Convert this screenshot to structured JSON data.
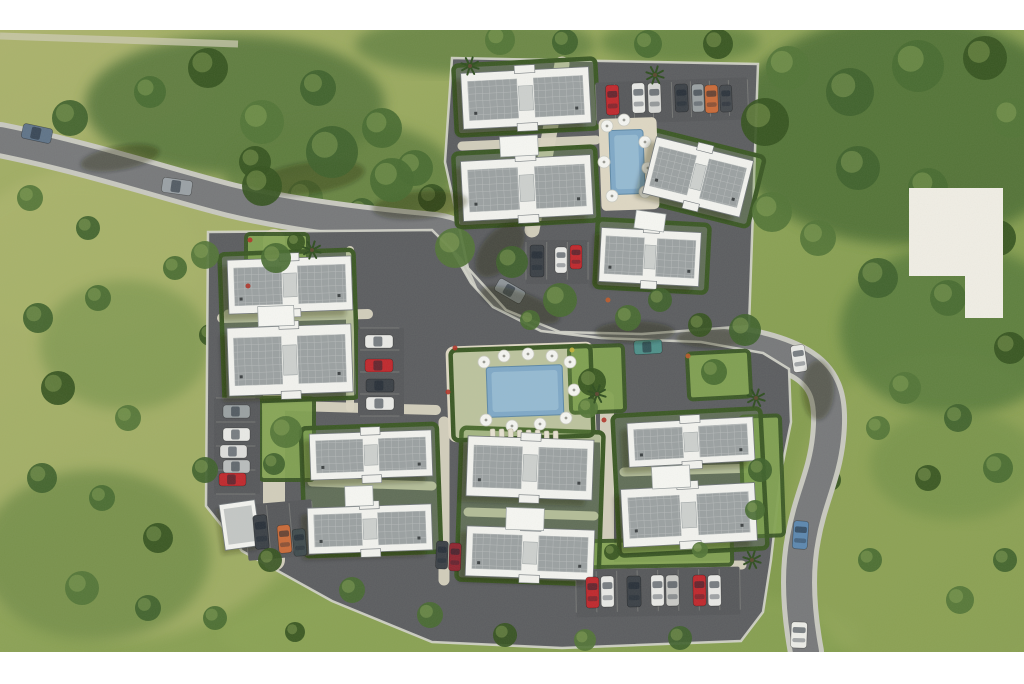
{
  "meta": {
    "scene": "aerial 3D rendering of a residential site plan with apartment blocks, roads, parking and pools"
  },
  "canvas": {
    "width": 1024,
    "height": 684,
    "photo_top": 30,
    "photo_bottom": 652,
    "letterbox_color": "#ffffff"
  },
  "palette": {
    "grass_a": "#a8b169",
    "grass_b": "#7c9748",
    "road": "#77787b",
    "sidewalk": "#c9c9c1",
    "parcel": "#5b5c60",
    "parcel_edge": "#d6d6cd",
    "walkway": "#d9d3c1",
    "hedge": "#3a5724",
    "lawn": "#83a352",
    "building_white": "#f3f3f0",
    "roof_gray": "#9ba0a2",
    "roof_core": "#cdd0cf",
    "pool_deck": "#ded7c4",
    "water": "#7fa8c8",
    "water_light": "#a8c8dd",
    "lot": "#56575b",
    "stall_line": "#8e8e8a",
    "logo_box": "#f1eee6",
    "tree_colors": [
      "#3f612c",
      "#486a31",
      "#35531f",
      "#527437"
    ]
  },
  "scene": {
    "grass_patches": [
      [
        120,
        400,
        230,
        240,
        "#b3b873",
        0.5
      ],
      [
        60,
        80,
        150,
        60,
        "#b0b572",
        0.45
      ],
      [
        540,
        635,
        320,
        55,
        "#8da557",
        0.5
      ],
      [
        940,
        520,
        150,
        170,
        "#96a75c",
        0.55
      ],
      [
        420,
        320,
        120,
        90,
        "#9fae63",
        0.35
      ],
      [
        80,
        260,
        120,
        80,
        "#a9b46b",
        0.4
      ]
    ],
    "forests": [
      [
        235,
        105,
        150,
        70,
        "#55753b",
        0.85
      ],
      [
        340,
        175,
        115,
        55,
        "#5d7c3e",
        0.8
      ],
      [
        905,
        130,
        175,
        115,
        "#4d6e34",
        0.88
      ],
      [
        955,
        330,
        115,
        85,
        "#55783a",
        0.8
      ],
      [
        95,
        555,
        115,
        85,
        "#60803e",
        0.6
      ],
      [
        125,
        345,
        85,
        65,
        "#6a8a44",
        0.5
      ],
      [
        955,
        465,
        85,
        55,
        "#6b8a45",
        0.5
      ],
      [
        475,
        45,
        120,
        30,
        "#5a7a3c",
        0.7
      ],
      [
        680,
        42,
        80,
        22,
        "#587a3a",
        0.7
      ]
    ],
    "trees": [
      [
        70,
        118,
        18
      ],
      [
        150,
        92,
        16
      ],
      [
        208,
        68,
        20
      ],
      [
        262,
        122,
        22
      ],
      [
        318,
        88,
        18
      ],
      [
        382,
        128,
        20
      ],
      [
        255,
        162,
        16
      ],
      [
        305,
        198,
        18
      ],
      [
        362,
        212,
        14
      ],
      [
        415,
        168,
        18
      ],
      [
        432,
        198,
        14
      ],
      [
        500,
        40,
        15
      ],
      [
        565,
        42,
        13
      ],
      [
        648,
        44,
        14
      ],
      [
        718,
        44,
        15
      ],
      [
        788,
        68,
        22
      ],
      [
        850,
        92,
        24
      ],
      [
        918,
        66,
        26
      ],
      [
        985,
        58,
        22
      ],
      [
        1012,
        118,
        20
      ],
      [
        858,
        168,
        22
      ],
      [
        928,
        188,
        20
      ],
      [
        998,
        238,
        18
      ],
      [
        818,
        238,
        18
      ],
      [
        878,
        278,
        20
      ],
      [
        948,
        298,
        18
      ],
      [
        1010,
        348,
        16
      ],
      [
        905,
        388,
        16
      ],
      [
        958,
        418,
        14
      ],
      [
        998,
        468,
        15
      ],
      [
        928,
        478,
        13
      ],
      [
        878,
        428,
        12
      ],
      [
        38,
        318,
        15
      ],
      [
        98,
        298,
        13
      ],
      [
        58,
        388,
        17
      ],
      [
        128,
        418,
        13
      ],
      [
        42,
        478,
        15
      ],
      [
        102,
        498,
        13
      ],
      [
        158,
        538,
        15
      ],
      [
        82,
        588,
        17
      ],
      [
        148,
        608,
        13
      ],
      [
        215,
        618,
        12
      ],
      [
        295,
        632,
        10
      ],
      [
        30,
        198,
        13
      ],
      [
        88,
        228,
        12
      ],
      [
        175,
        268,
        12
      ],
      [
        210,
        335,
        11
      ],
      [
        960,
        600,
        14
      ],
      [
        1005,
        560,
        12
      ],
      [
        870,
        560,
        12
      ],
      [
        830,
        480,
        11
      ]
    ],
    "overhang_trees": [
      [
        332,
        152,
        26
      ],
      [
        392,
        180,
        22
      ],
      [
        262,
        186,
        20
      ],
      [
        455,
        248,
        20
      ],
      [
        512,
        262,
        16
      ],
      [
        560,
        300,
        17
      ],
      [
        765,
        122,
        24
      ],
      [
        772,
        212,
        20
      ],
      [
        745,
        330,
        16
      ],
      [
        628,
        318,
        13
      ],
      [
        700,
        325,
        12
      ],
      [
        205,
        255,
        14
      ],
      [
        205,
        470,
        13
      ],
      [
        430,
        615,
        13
      ],
      [
        505,
        635,
        12
      ],
      [
        585,
        640,
        11
      ],
      [
        680,
        638,
        12
      ],
      [
        352,
        590,
        13
      ],
      [
        270,
        560,
        12
      ]
    ],
    "road": {
      "path": "M0 140 C90 158 170 185 230 200 C300 217 390 226 435 230 C468 234 480 258 492 290 C505 320 540 331 600 336 L700 340 C745 343 775 349 800 363 C826 378 832 400 828 438 C824 476 810 498 803 538 C796 574 799 614 806 652",
      "asphalt_w": 26,
      "sidewalk_w": 36
    },
    "road_shadows": [
      [
        310,
        178,
        55,
        16,
        -8
      ],
      [
        420,
        205,
        48,
        14,
        -5
      ],
      [
        120,
        158,
        40,
        12,
        -10
      ],
      [
        520,
        305,
        42,
        13,
        20
      ],
      [
        635,
        332,
        40,
        11,
        0
      ],
      [
        712,
        338,
        36,
        10,
        0
      ],
      [
        818,
        390,
        16,
        30,
        0
      ],
      [
        500,
        250,
        18,
        32,
        40
      ]
    ],
    "parcels": [
      {
        "name": "north-parcel",
        "points": "452,58 758,64 749,326 642,334 560,332 506,310 468,268 445,162"
      },
      {
        "name": "main-parcel",
        "points": "208,232 432,230 452,250 471,283 493,307 541,331 601,338 701,342 763,353 789,369 791,422 781,472 771,560 763,612 741,641 562,648 432,642 332,601 242,551 206,506"
      }
    ],
    "walk_strokes": [
      [
        "M562,64 L532,230",
        15
      ],
      [
        "M274,240 L274,560",
        22
      ],
      [
        "M222,318 L368,314",
        10
      ],
      [
        "M224,404 L436,410",
        10
      ],
      [
        "M607,398 L607,586",
        14
      ],
      [
        "M444,422 L444,580",
        11
      ],
      [
        "M580,567 L742,565",
        9
      ],
      [
        "M350,250 L350,408",
        8
      ],
      [
        "M455,432 L600,438",
        9
      ],
      [
        "M462,146 L596,140",
        9
      ],
      [
        "M228,314 L352,312",
        9
      ],
      [
        "M312,482 L432,486",
        9
      ],
      [
        "M468,512 L594,516",
        9
      ],
      [
        "M624,472 L756,468",
        9
      ]
    ],
    "plaza": {
      "x": 447,
      "y": 344,
      "w": 148,
      "h": 96,
      "rot": -2,
      "rx": 8
    },
    "gardens": [
      [
        246,
        234,
        62,
        56,
        0
      ],
      [
        260,
        398,
        54,
        82,
        0
      ],
      [
        688,
        352,
        62,
        46,
        -3
      ],
      [
        570,
        346,
        54,
        66,
        -2
      ],
      [
        584,
        540,
        148,
        26,
        -1
      ],
      [
        742,
        416,
        40,
        120,
        -2
      ]
    ],
    "garden_trees": [
      [
        276,
        258,
        15
      ],
      [
        296,
        242,
        9
      ],
      [
        286,
        432,
        16
      ],
      [
        274,
        464,
        11
      ],
      [
        714,
        372,
        13
      ],
      [
        592,
        382,
        14
      ],
      [
        588,
        408,
        10
      ],
      [
        760,
        470,
        12
      ],
      [
        755,
        510,
        10
      ],
      [
        612,
        552,
        8
      ],
      [
        700,
        550,
        8
      ],
      [
        660,
        300,
        12
      ],
      [
        530,
        320,
        10
      ]
    ],
    "flowers": [
      [
        250,
        240,
        "#b03228"
      ],
      [
        455,
        348,
        "#b03228"
      ],
      [
        572,
        350,
        "#c8b33a"
      ],
      [
        604,
        420,
        "#b03228"
      ],
      [
        688,
        356,
        "#c05a2a"
      ],
      [
        248,
        286,
        "#b03228"
      ],
      [
        608,
        300,
        "#c05a2a"
      ],
      [
        448,
        392,
        "#b03228"
      ]
    ],
    "hedges": [
      [
        222,
        252,
        134,
        148,
        -2
      ],
      [
        303,
        426,
        136,
        128,
        -2
      ],
      [
        459,
        430,
        142,
        152,
        2
      ],
      [
        616,
        412,
        148,
        140,
        -3
      ],
      [
        455,
        62,
        142,
        70,
        -3
      ],
      [
        455,
        150,
        142,
        74,
        -3
      ],
      [
        596,
        222,
        112,
        68,
        3
      ],
      [
        640,
        142,
        118,
        72,
        14
      ],
      [
        452,
        348,
        140,
        90,
        -2
      ]
    ],
    "parking_lots": [
      [
        596,
        80,
        152,
        42,
        -2,
        8,
        "v"
      ],
      [
        526,
        240,
        62,
        44,
        0,
        3,
        "v"
      ],
      [
        214,
        398,
        46,
        96,
        0,
        4,
        "h"
      ],
      [
        358,
        328,
        46,
        88,
        0,
        4,
        "h"
      ],
      [
        576,
        568,
        164,
        48,
        -1,
        8,
        "v"
      ],
      [
        246,
        502,
        68,
        56,
        -5,
        3,
        "v"
      ]
    ],
    "pools": [
      {
        "deck": [
          600,
          118,
          58,
          92,
          -2
        ],
        "water": [
          610,
          130,
          34,
          64,
          -2
        ],
        "umbrellas": [
          [
            607,
            126
          ],
          [
            624,
            120
          ],
          [
            645,
            142
          ],
          [
            648,
            168
          ],
          [
            645,
            192
          ],
          [
            612,
            196
          ],
          [
            604,
            162
          ]
        ],
        "loungers": []
      },
      {
        "deck": [
          0,
          0,
          0,
          0,
          0
        ],
        "water": [
          487,
          366,
          76,
          50,
          -2
        ],
        "umbrellas": [
          [
            484,
            362
          ],
          [
            504,
            356
          ],
          [
            528,
            354
          ],
          [
            552,
            356
          ],
          [
            570,
            362
          ],
          [
            574,
            390
          ],
          [
            566,
            418
          ],
          [
            540,
            424
          ],
          [
            512,
            426
          ],
          [
            486,
            420
          ]
        ],
        "loungers": [
          [
            490,
            429
          ],
          [
            499,
            429
          ],
          [
            508,
            429
          ],
          [
            517,
            430
          ],
          [
            526,
            430
          ],
          [
            535,
            430
          ],
          [
            544,
            431
          ],
          [
            553,
            431
          ]
        ]
      }
    ],
    "buildings": [
      [
        462,
        70,
        128,
        56,
        -3
      ],
      [
        462,
        158,
        130,
        60,
        -3
      ],
      [
        648,
        148,
        100,
        58,
        14
      ],
      [
        600,
        230,
        100,
        54,
        3
      ],
      [
        228,
        258,
        124,
        54,
        -2
      ],
      [
        228,
        326,
        124,
        68,
        -2
      ],
      [
        310,
        432,
        122,
        46,
        -2
      ],
      [
        308,
        506,
        124,
        46,
        -2
      ],
      [
        467,
        438,
        126,
        60,
        2
      ],
      [
        466,
        528,
        128,
        50,
        2
      ],
      [
        628,
        420,
        126,
        44,
        -3
      ],
      [
        622,
        486,
        134,
        58,
        -3
      ]
    ],
    "connectors": [
      [
        500,
        136,
        38,
        20,
        -3
      ],
      [
        258,
        306,
        36,
        20,
        -2
      ],
      [
        345,
        486,
        28,
        20,
        -2
      ],
      [
        506,
        508,
        38,
        22,
        2
      ],
      [
        652,
        466,
        38,
        22,
        -3
      ],
      [
        635,
        212,
        30,
        18,
        8
      ]
    ],
    "garage": {
      "x": 222,
      "y": 502,
      "w": 36,
      "h": 46,
      "rot": -8
    },
    "cars": [
      [
        22,
        126,
        30,
        15,
        12,
        "#5f7389"
      ],
      [
        162,
        179,
        30,
        15,
        8,
        "#9aa0a6"
      ],
      [
        495,
        284,
        30,
        14,
        30,
        "#8f959b"
      ],
      [
        634,
        340,
        28,
        14,
        -3,
        "#4e8f8a"
      ],
      [
        792,
        345,
        14,
        27,
        -8,
        "#e9e9e7"
      ],
      [
        793,
        521,
        15,
        28,
        4,
        "#5c87b0"
      ],
      [
        791,
        622,
        16,
        26,
        2,
        "#edede9"
      ],
      [
        606,
        85,
        13,
        30,
        -2,
        "#c0272d"
      ],
      [
        632,
        83,
        13,
        30,
        -2,
        "#e9e9e7"
      ],
      [
        648,
        83,
        13,
        30,
        -2,
        "#d7d7d5"
      ],
      [
        675,
        84,
        13,
        28,
        -2,
        "#3a3f46"
      ],
      [
        692,
        84,
        12,
        28,
        -2,
        "#9aa0a3"
      ],
      [
        705,
        85,
        13,
        28,
        -2,
        "#c96a3a"
      ],
      [
        720,
        85,
        12,
        27,
        -2,
        "#44484e"
      ],
      [
        530,
        245,
        14,
        32,
        0,
        "#3a3f46"
      ],
      [
        555,
        247,
        12,
        26,
        0,
        "#e9e9e7"
      ],
      [
        570,
        245,
        12,
        24,
        0,
        "#c0272d"
      ],
      [
        365,
        335,
        28,
        13,
        0,
        "#e9e9e7"
      ],
      [
        365,
        359,
        28,
        13,
        0,
        "#c0272d"
      ],
      [
        366,
        379,
        28,
        13,
        0,
        "#3a3f46"
      ],
      [
        366,
        397,
        28,
        13,
        0,
        "#e9e9e7"
      ],
      [
        223,
        405,
        27,
        13,
        0,
        "#9aa0a3"
      ],
      [
        223,
        428,
        27,
        13,
        0,
        "#e9e9e7"
      ],
      [
        220,
        445,
        27,
        13,
        0,
        "#dededd"
      ],
      [
        223,
        460,
        27,
        13,
        0,
        "#b9bcbd"
      ],
      [
        219,
        473,
        27,
        13,
        0,
        "#c0272d"
      ],
      [
        254,
        515,
        14,
        34,
        -5,
        "#3a3f46"
      ],
      [
        278,
        525,
        13,
        28,
        -5,
        "#c96a3a"
      ],
      [
        293,
        529,
        13,
        27,
        -5,
        "#3f4a4e"
      ],
      [
        436,
        541,
        12,
        28,
        2,
        "#3a3f46"
      ],
      [
        449,
        543,
        12,
        28,
        2,
        "#8f2430"
      ],
      [
        586,
        577,
        13,
        31,
        -1,
        "#c0272d"
      ],
      [
        601,
        576,
        13,
        31,
        -1,
        "#e9e9e7"
      ],
      [
        627,
        576,
        14,
        31,
        -1,
        "#3a3f46"
      ],
      [
        651,
        575,
        13,
        31,
        -1,
        "#e9e9e7"
      ],
      [
        666,
        575,
        13,
        31,
        -1,
        "#c9c9c7"
      ],
      [
        693,
        575,
        13,
        31,
        -1,
        "#c0272d"
      ],
      [
        708,
        575,
        13,
        31,
        -1,
        "#e9e9e7"
      ]
    ],
    "palms": [
      [
        470,
        66
      ],
      [
        655,
        75
      ],
      [
        597,
        394
      ],
      [
        752,
        560
      ],
      [
        756,
        398
      ],
      [
        312,
        250
      ]
    ],
    "logo_box": "909,188 1003,188 1003,318 965,318 965,276 909,276",
    "wall": {
      "d": "M0,36 L238,44",
      "w": 7,
      "c": "#ccc9b2",
      "o": 0.75
    }
  }
}
